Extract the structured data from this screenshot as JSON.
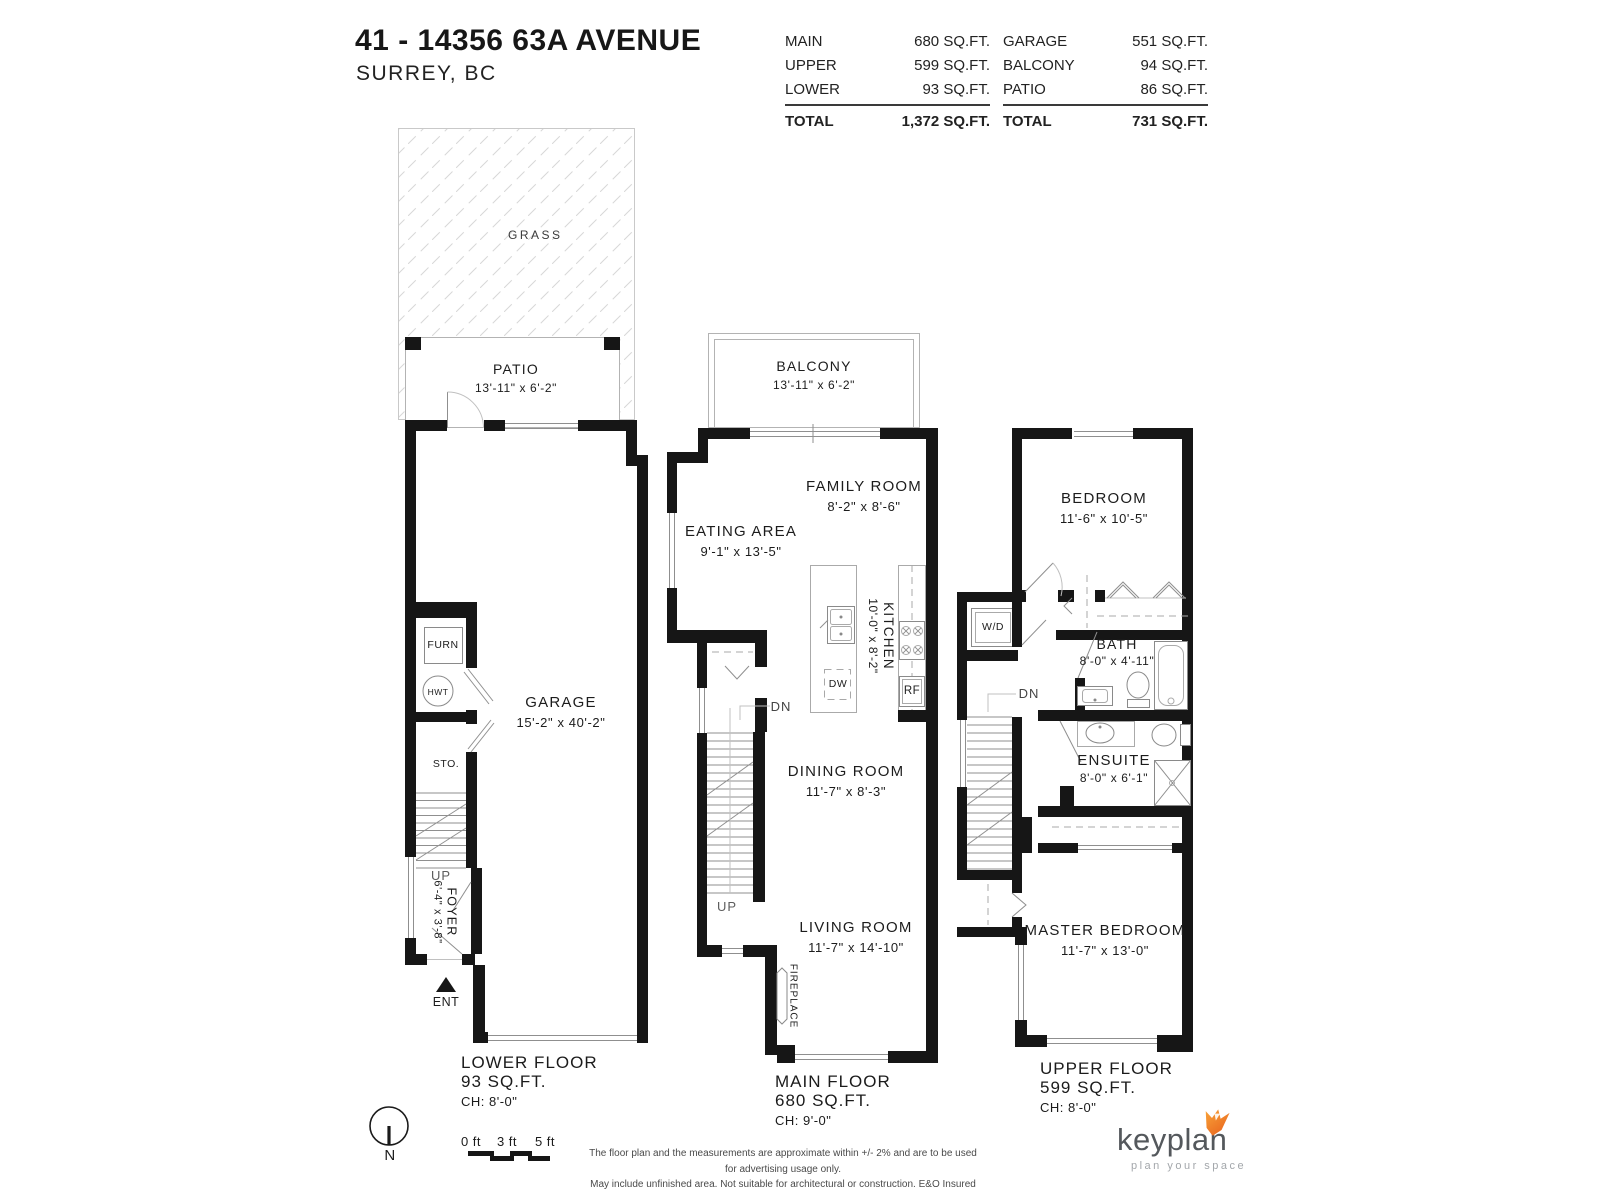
{
  "header": {
    "title": "41 - 14356 63A AVENUE",
    "subtitle": "SURREY, BC",
    "table": {
      "left": {
        "rows": [
          {
            "label": "MAIN",
            "value": "680 SQ.FT."
          },
          {
            "label": "UPPER",
            "value": "599 SQ.FT."
          },
          {
            "label": "LOWER",
            "value": "93 SQ.FT."
          }
        ],
        "total_label": "TOTAL",
        "total_value": "1,372 SQ.FT."
      },
      "right": {
        "rows": [
          {
            "label": "GARAGE",
            "value": "551 SQ.FT."
          },
          {
            "label": "BALCONY",
            "value": "94 SQ.FT."
          },
          {
            "label": "PATIO",
            "value": "86 SQ.FT."
          }
        ],
        "total_label": "TOTAL",
        "total_value": "731 SQ.FT."
      }
    }
  },
  "lower_floor": {
    "grass": "GRASS",
    "patio": {
      "name": "PATIO",
      "dims": "13'-11\" x 6'-2\""
    },
    "garage": {
      "name": "GARAGE",
      "dims": "15'-2\" x 40'-2\""
    },
    "foyer": {
      "name": "FOYER",
      "dims": "6'-4\" x 3'-8\""
    },
    "furn": "FURN",
    "hwt": "HWT",
    "sto": "STO.",
    "up": "UP",
    "ent": "ENT",
    "caption": {
      "line1": "LOWER FLOOR",
      "line2": "93 SQ.FT.",
      "line3": "CH: 8'-0\""
    }
  },
  "main_floor": {
    "balcony": {
      "name": "BALCONY",
      "dims": "13'-11\" x 6'-2\""
    },
    "family_room": {
      "name": "FAMILY ROOM",
      "dims": "8'-2\" x 8'-6\""
    },
    "eating_area": {
      "name": "EATING AREA",
      "dims": "9'-1\" x 13'-5\""
    },
    "kitchen": {
      "name": "KITCHEN",
      "dims": "10'-0\" x 8'-2\""
    },
    "dining_room": {
      "name": "DINING ROOM",
      "dims": "11'-7\" x 8'-3\""
    },
    "living_room": {
      "name": "LIVING ROOM",
      "dims": "11'-7\" x 14'-10\""
    },
    "fireplace": "FIREPLACE",
    "dw": "DW",
    "rf": "RF",
    "dn": "DN",
    "up": "UP",
    "caption": {
      "line1": "MAIN FLOOR",
      "line2": "680 SQ.FT.",
      "line3": "CH: 9'-0\""
    }
  },
  "upper_floor": {
    "bedroom": {
      "name": "BEDROOM",
      "dims": "11'-6\" x 10'-5\""
    },
    "bath": {
      "name": "BATH",
      "dims": "8'-0\" x 4'-11\""
    },
    "ensuite": {
      "name": "ENSUITE",
      "dims": "8'-0\" x 6'-1\""
    },
    "master_bedroom": {
      "name": "MASTER BEDROOM",
      "dims": "11'-7\" x 13'-0\""
    },
    "wd": "W/D",
    "dn": "DN",
    "caption": {
      "line1": "UPPER FLOOR",
      "line2": "599 SQ.FT.",
      "line3": "CH: 8'-0\""
    }
  },
  "footer": {
    "north": "N",
    "scale": {
      "t0": "0 ft",
      "t3": "3 ft",
      "t5": "5 ft"
    },
    "disclaimer": {
      "line1": "The floor plan and the measurements are approximate within +/- 2% and are to be used for advertising usage only.",
      "line2": "May include unfinished area. Not suitable for architectural or construction. E&O Insured"
    },
    "logo": {
      "name": "keyplan",
      "tagline": "plan your space"
    },
    "colors": {
      "fox_light": "#f9a63a",
      "fox_dark": "#e8611c",
      "wall": "#161616"
    }
  }
}
